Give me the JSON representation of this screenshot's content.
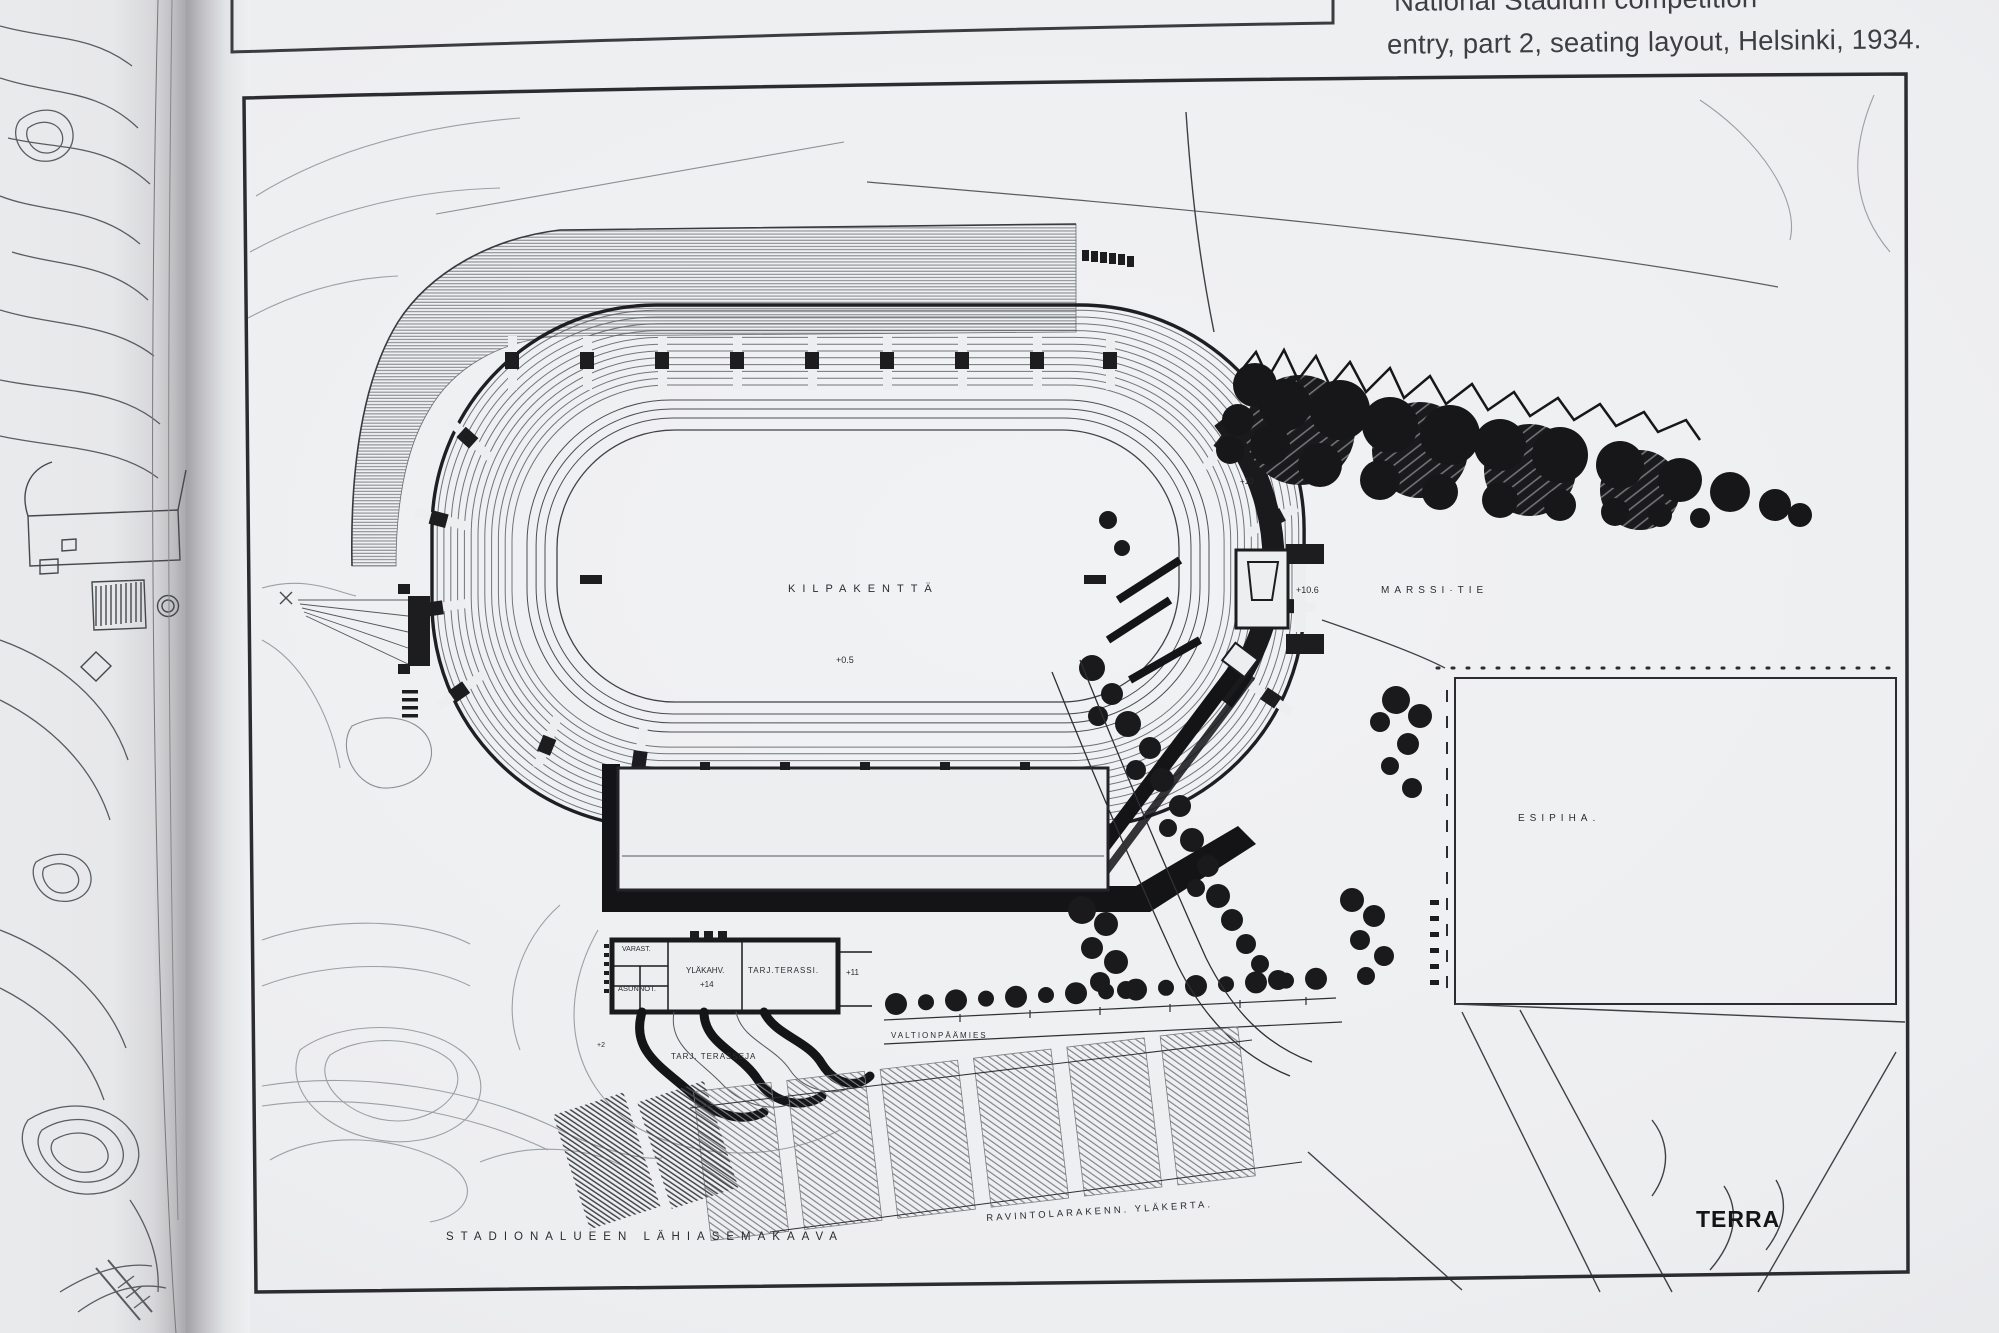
{
  "photo": {
    "paper_color": "#edeef0",
    "ink_color": "#1d1d20",
    "faint_line_color": "#9aa0a4"
  },
  "caption": {
    "line1": "National Stadium competition",
    "line2": "entry, part 2, seating layout, Helsinki, 1934."
  },
  "plan": {
    "field_label": "KILPAKENTTÄ",
    "field_elevation": "+0.5",
    "road_east_label": "MARSSI·TIE",
    "elevation_plus10": "+10",
    "elevation_plus106": "+10.6",
    "forecourt_label": "ESIPIHA.",
    "road_south_label": "VALTIONPÄÄMIES",
    "rooms": {
      "storage": "VARAST.",
      "apartments": "ASUNNOT.",
      "upper_cafe": "YLÄKAHV.",
      "upper_cafe_elevation": "+14",
      "serving_terrace": "TARJ.TERASSI.",
      "terrace_elevation": "+11"
    },
    "terraces_label": "TARJ. TERASSEJA",
    "terraces_elevation": "+2",
    "drawing_title": "STADIONALUEEN LÄHIASEMAKAAVA",
    "restaurant_label": "RAVINTOLARAKENN. YLÄKERTA.",
    "signature": "TERRA"
  }
}
